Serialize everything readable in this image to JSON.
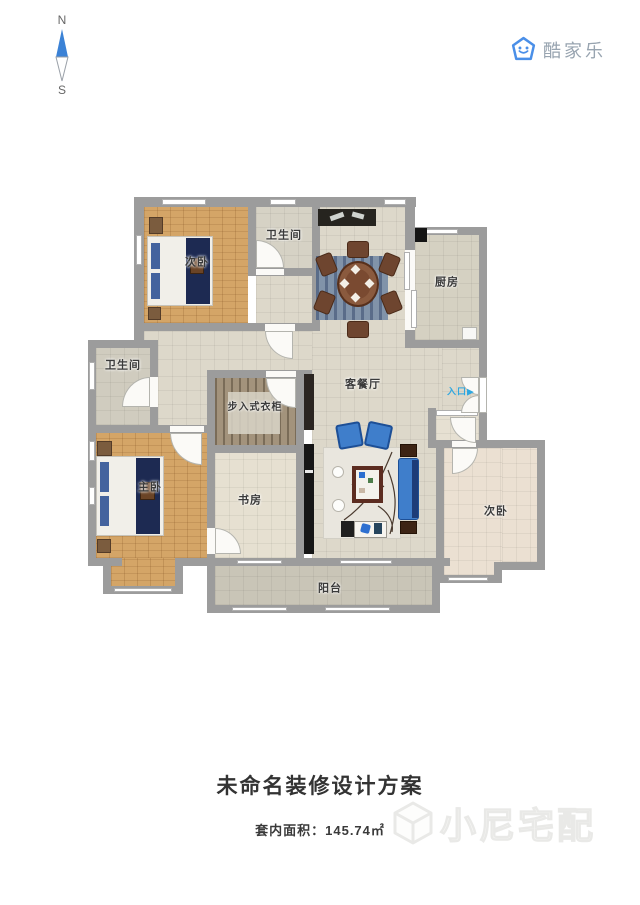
{
  "compass": {
    "north": "N",
    "south": "S"
  },
  "logo": {
    "text": "酷家乐"
  },
  "rooms": {
    "bedroom_top": {
      "label": "次卧"
    },
    "bath_top": {
      "label": "卫生间"
    },
    "kitchen": {
      "label": "厨房"
    },
    "bath_left": {
      "label": "卫生间"
    },
    "living": {
      "label": "客餐厅"
    },
    "closet": {
      "label": "步入式衣柜"
    },
    "master": {
      "label": "主卧"
    },
    "study": {
      "label": "书房"
    },
    "bedroom_right": {
      "label": "次卧"
    },
    "balcony": {
      "label": "阳台"
    },
    "entrance": {
      "label": "入口",
      "arrow": "▶"
    }
  },
  "footer": {
    "title": "未命名装修设计方案",
    "area_label": "套内面积：",
    "area_value": "145.74㎡",
    "watermark": "小尼宅配"
  },
  "colors": {
    "wall": "#9c9c9c",
    "wood_floor": "#d4a567",
    "tile_floor": "#ddd8ca",
    "accent_blue": "#3f7ecb",
    "bed_runner_navy": "#1d2a52",
    "entrance_blue": "#2ea7e0",
    "logo_blue": "#4a8fe8",
    "furniture_brown": "#6e452f"
  }
}
